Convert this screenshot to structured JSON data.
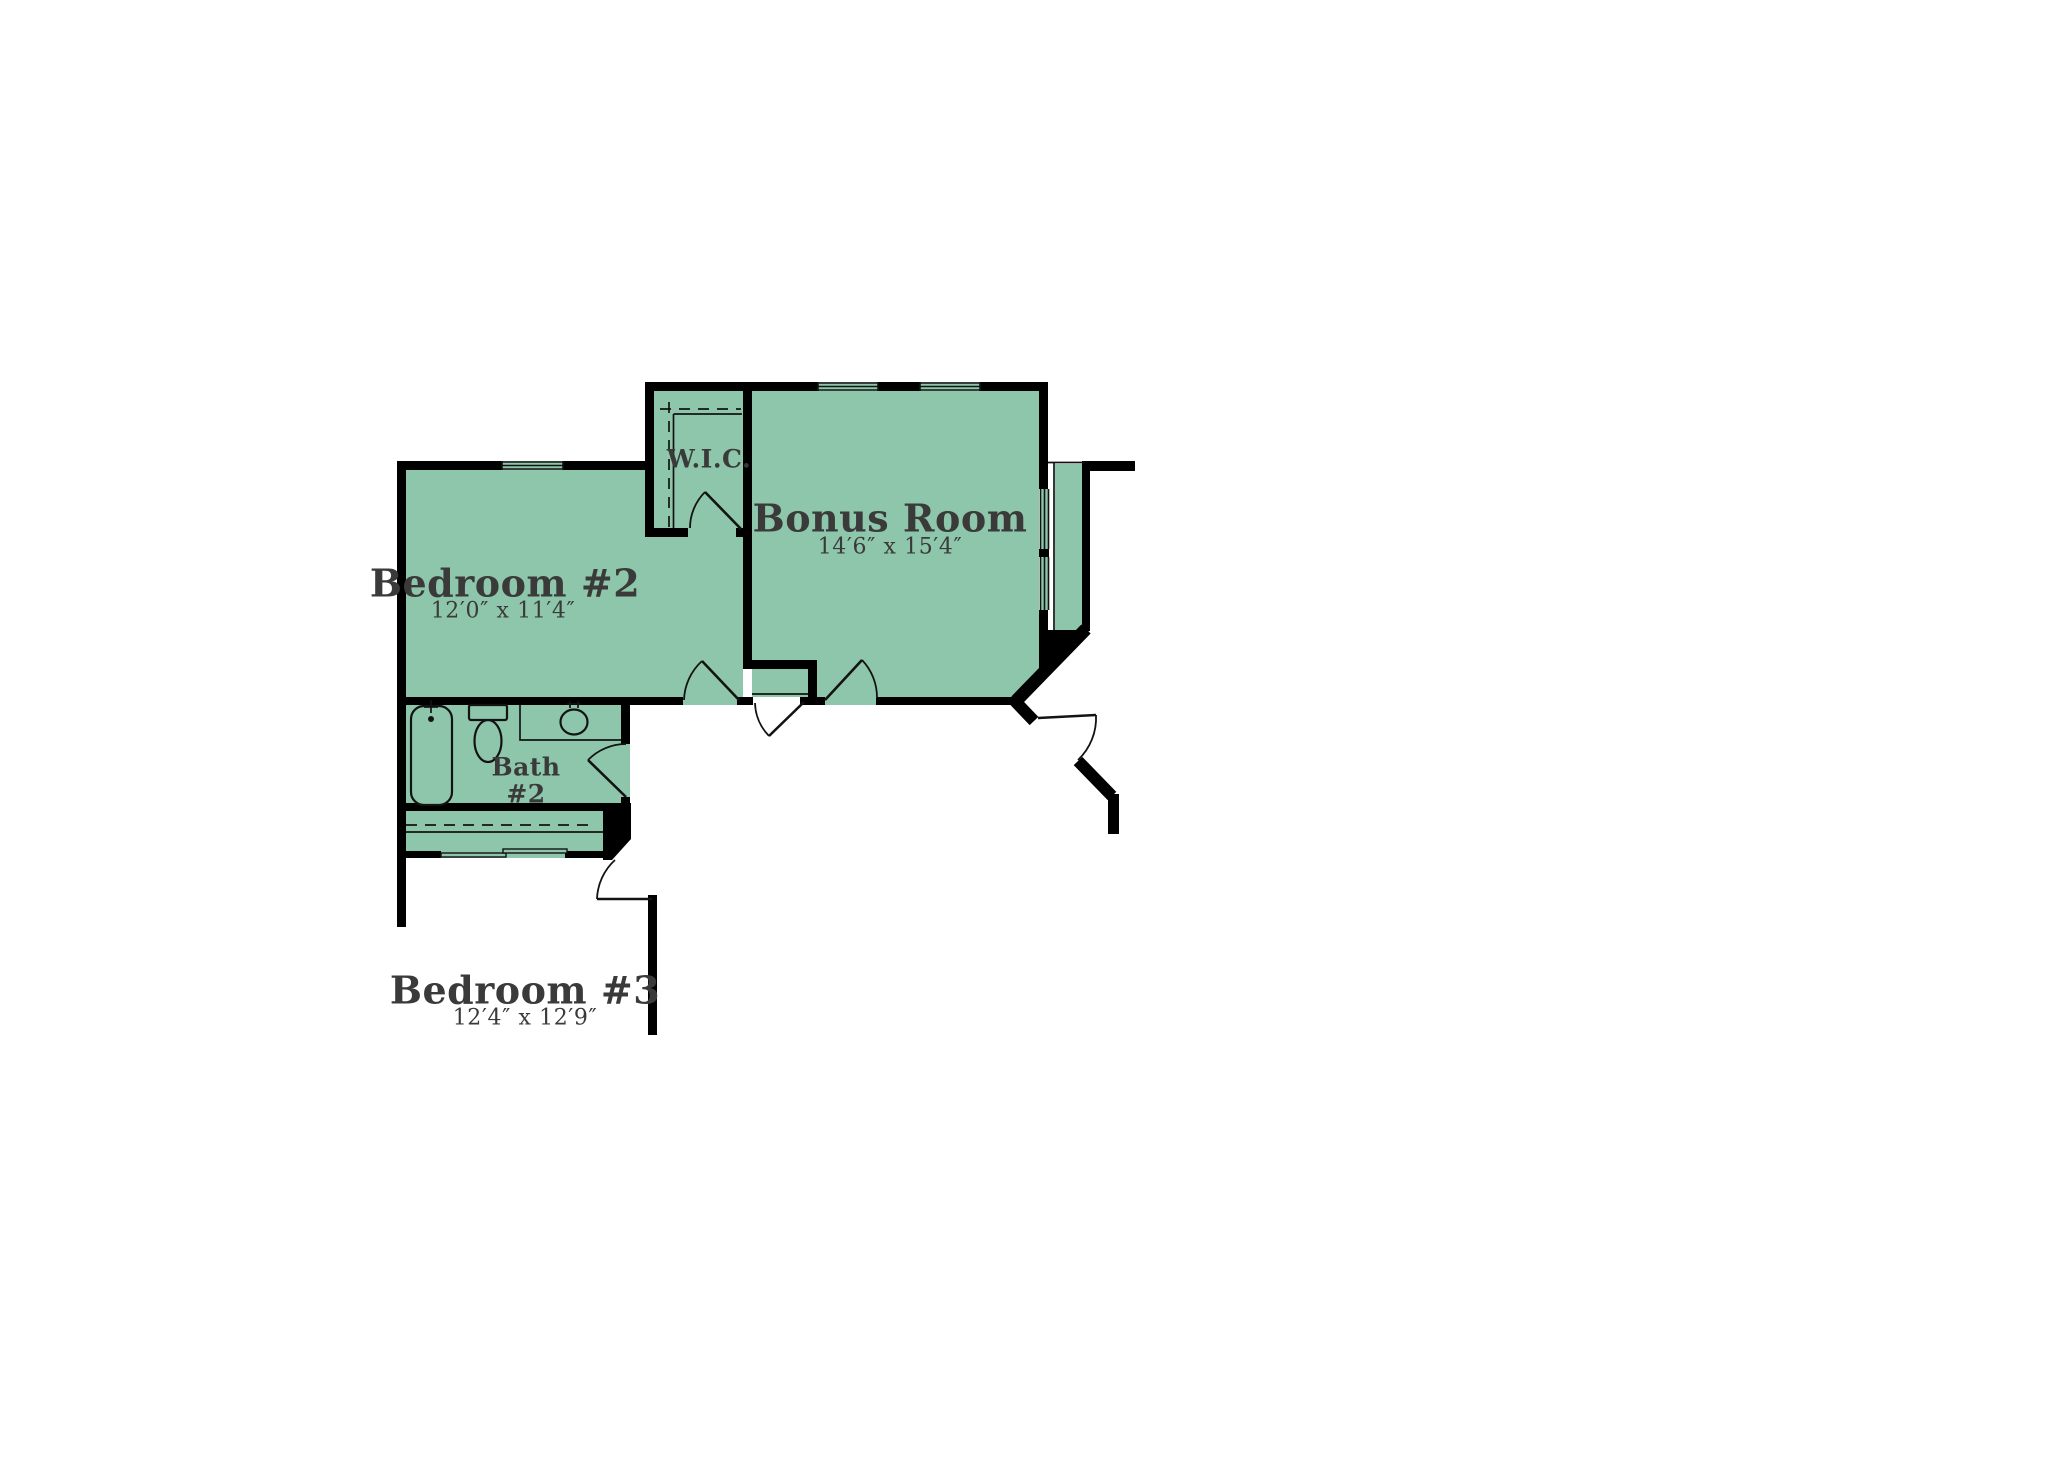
{
  "colors": {
    "background": "#ffffff",
    "room_fill": "#8ec6ab",
    "wall": "#000000",
    "line": "#131313",
    "text": "#3a3a3a"
  },
  "rooms": {
    "bedroom2": {
      "name": "Bedroom #2",
      "dims": "12′0″ x 11′4″"
    },
    "bonus_room": {
      "name": "Bonus Room",
      "dims": "14′6″ x 15′4″"
    },
    "wic": {
      "name": "W.I.C."
    },
    "bath2": {
      "name": "Bath",
      "number": "#2"
    },
    "bedroom3": {
      "name": "Bedroom #3",
      "dims": "12′4″ x 12′9″"
    }
  },
  "fixtures": [
    "bathtub",
    "toilet",
    "sink-vanity",
    "closet-rod",
    "closet-shelf",
    "bypass-closet-doors",
    "door-swing",
    "window"
  ]
}
